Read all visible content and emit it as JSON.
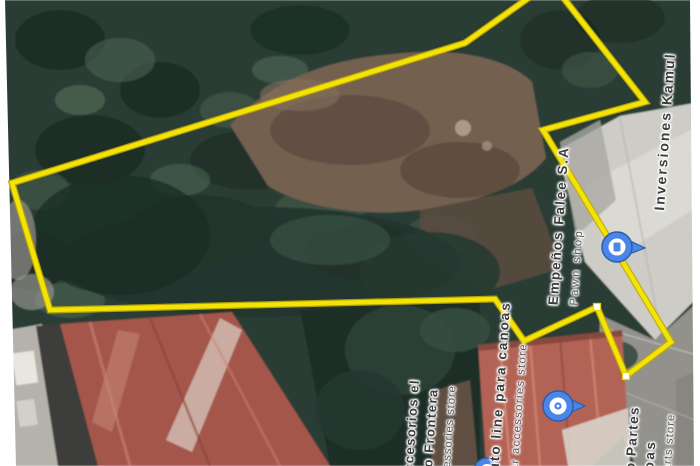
{
  "labels": {
    "inversiones": {
      "name": "Inversiones Kamul"
    },
    "empenos": {
      "name": "Empeños Falee S.A",
      "category": "Pawn shop"
    },
    "autoline": {
      "name": "Auto line para canoas",
      "category": "Car accessories store"
    },
    "frontera": {
      "line1": "accesorios el",
      "line2": "uto Frontera",
      "category": "ccessories store"
    },
    "partes": {
      "line1": "o Partes",
      "line2": "noas",
      "category": "parts store"
    }
  },
  "pins": {
    "pawn": "pawn-shop-pin",
    "car": "car-accessories-pin",
    "partial": "partial-place-pin"
  },
  "boundary": {
    "points": "12,183 465,43 551,-18 645,102 543,130 671,342 626,376 597,307 524,341 495,299 50,310",
    "vertex_markers": 2
  },
  "colors": {
    "boundary": "#f4e307",
    "boundary_edge": "#c2aa02",
    "pin_blue": "#4a86e8",
    "pin_dark": "#2d5cae",
    "label_dark": "#3d3d3d",
    "label_gray": "#545454"
  }
}
